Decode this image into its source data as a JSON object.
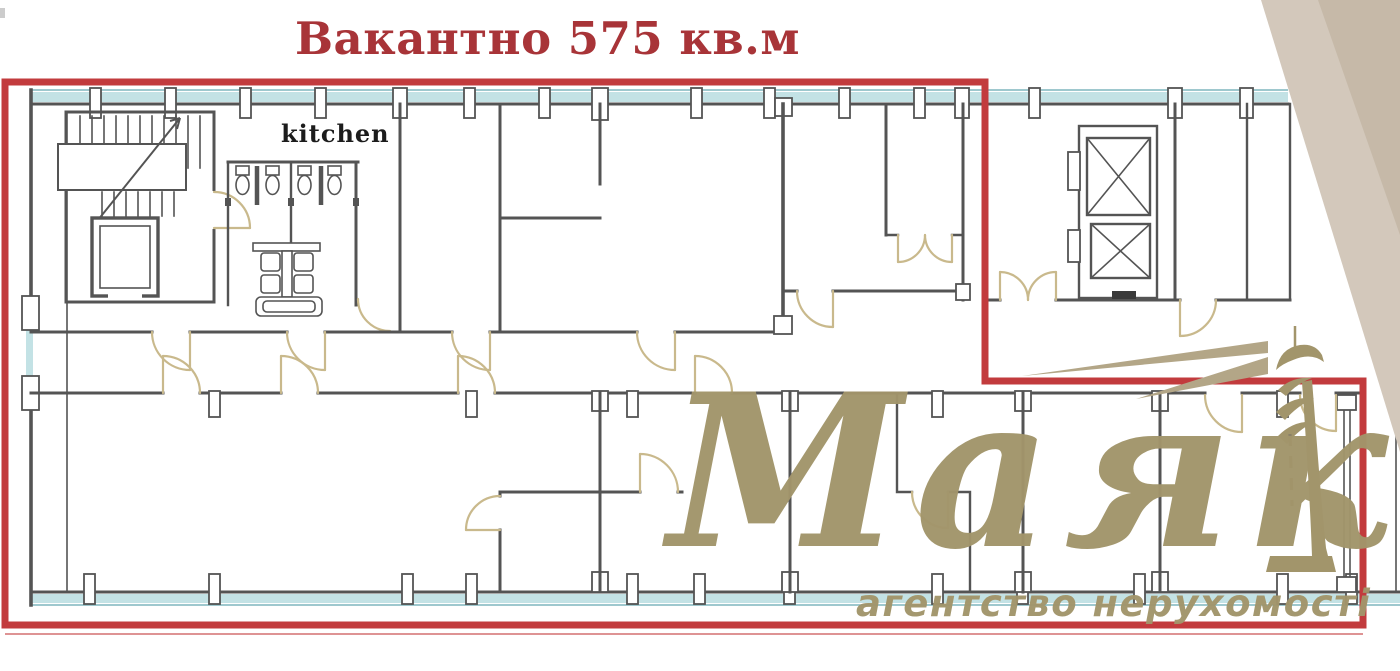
{
  "title": {
    "text": "Вакантно 575 кв.м"
  },
  "plan": {
    "kitchen_label": "kitchen",
    "vacant_area_sqm": "575"
  },
  "watermark": {
    "brand": "Маяк",
    "tagline": "агентство нерухомості"
  },
  "colors": {
    "accent_red": "#c23b3d",
    "title_red": "#a83438",
    "logo_gold": "#a2956b",
    "beam_gold": "#b3a687",
    "wall_gray": "#545454",
    "window_teal": "#c3e2e5",
    "window_frame": "#7fb6bd",
    "door_tan": "#c9b98c",
    "corner_beige": "#d3c8bb",
    "corner_beige_dark": "#c3b6a5"
  }
}
